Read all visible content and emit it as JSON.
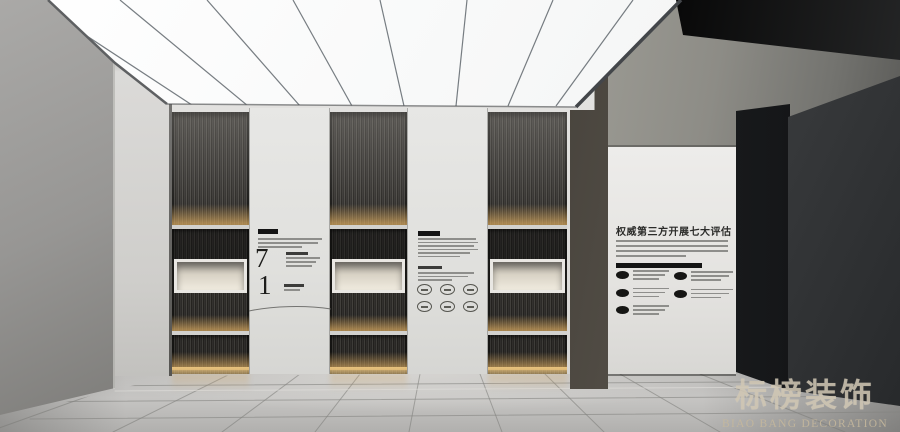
{
  "back_wall": {
    "panel_left": {
      "number_top": "7",
      "number_bottom": "1"
    },
    "panel_middle": {
      "badge_count": 6
    },
    "shelf_unit_count": 3
  },
  "right_wall_panel": {
    "title": "权威第三方开展七大评估",
    "list_left_count": 3,
    "list_right_count": 2
  },
  "watermark": {
    "brand_cn": "标榜装饰",
    "brand_en": "BIAO BANG DECORATION"
  },
  "colors": {
    "warm_shelf_light": "#d8ae6e",
    "ceiling_light": "#f8f9f9",
    "floor": "#bdbcba",
    "watermark_text": "#cbb89b",
    "black_ceiling_panel": "#0d0d0d"
  }
}
